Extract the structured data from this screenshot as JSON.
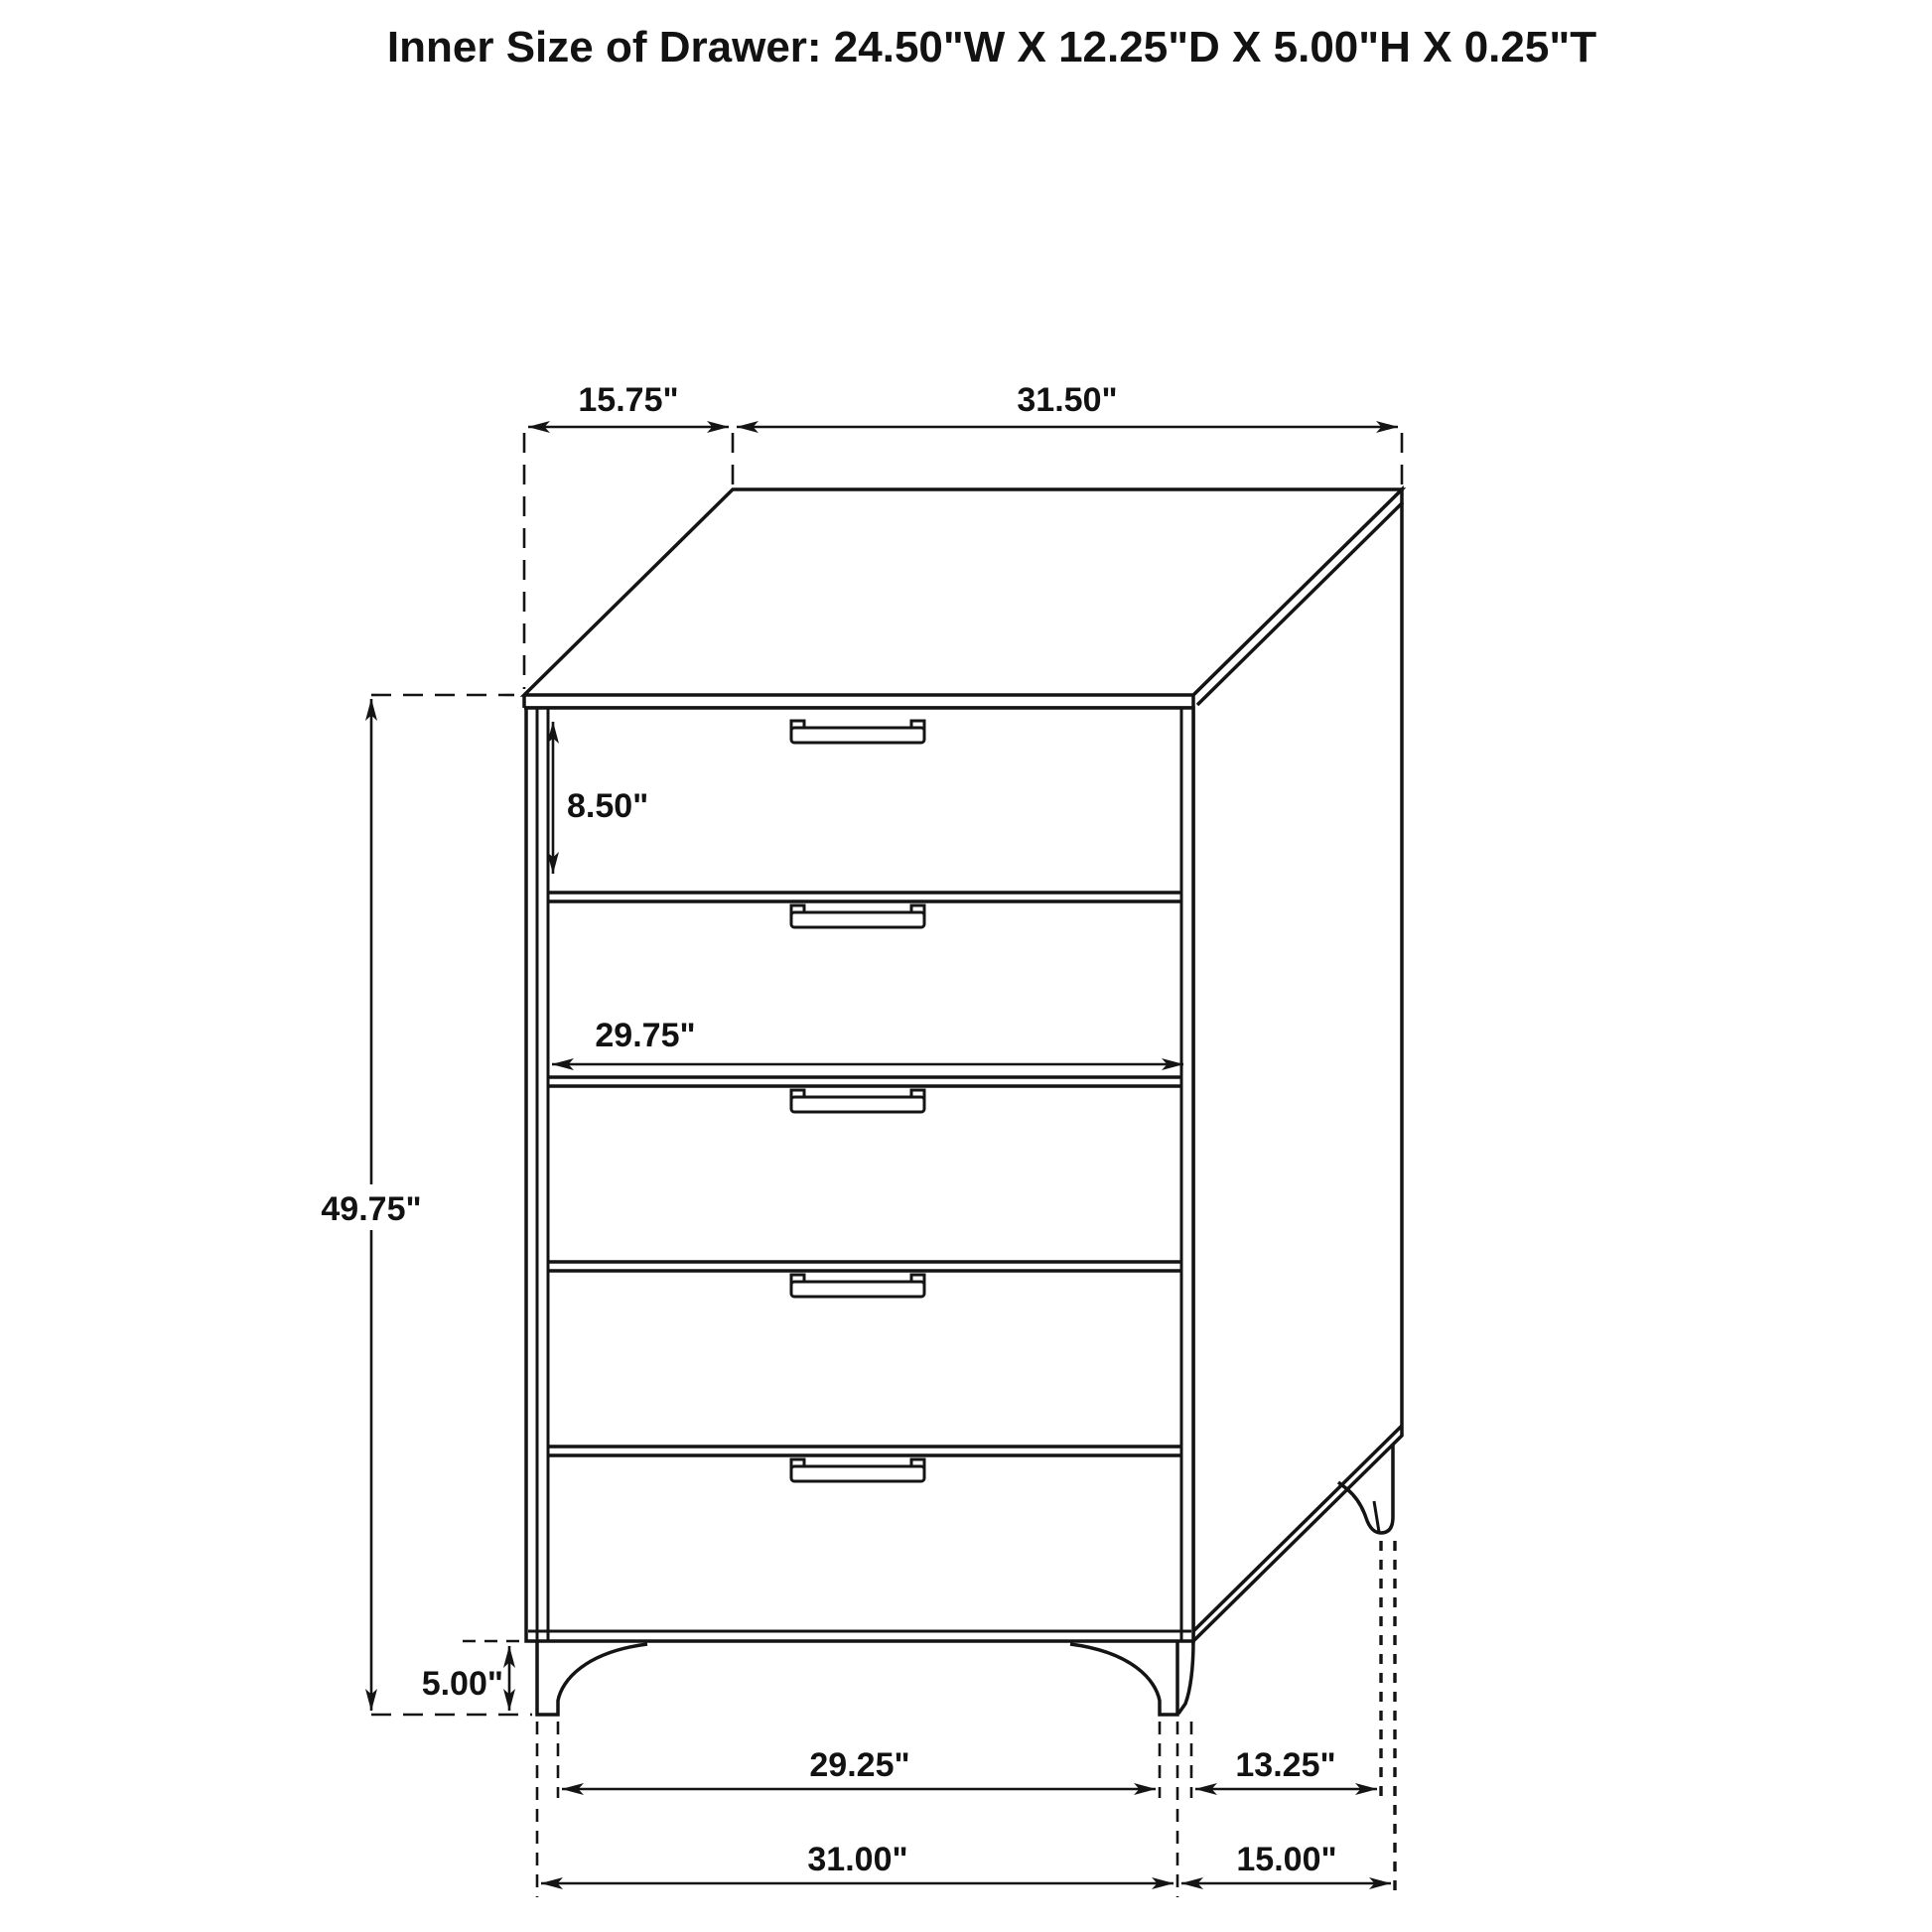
{
  "page": {
    "background": "#ffffff"
  },
  "title": {
    "text": "Inner Size of Drawer: 24.50\"W X 12.25\"D X 5.00\"H X 0.25\"T"
  },
  "drawing": {
    "subject": "five-drawer-chest-dimension-diagram",
    "drawer_count": 5,
    "line_color": "#141414",
    "labels": {
      "top_depth": "15.75\"",
      "top_width": "31.50\"",
      "first_drawer_height": "8.50\"",
      "drawer_front_width": "29.75\"",
      "overall_height": "49.75\"",
      "leg_height": "5.00\"",
      "front_leg_span": "29.25\"",
      "side_leg_span": "13.25\"",
      "overall_width": "31.00\"",
      "overall_depth": "15.00\""
    }
  }
}
